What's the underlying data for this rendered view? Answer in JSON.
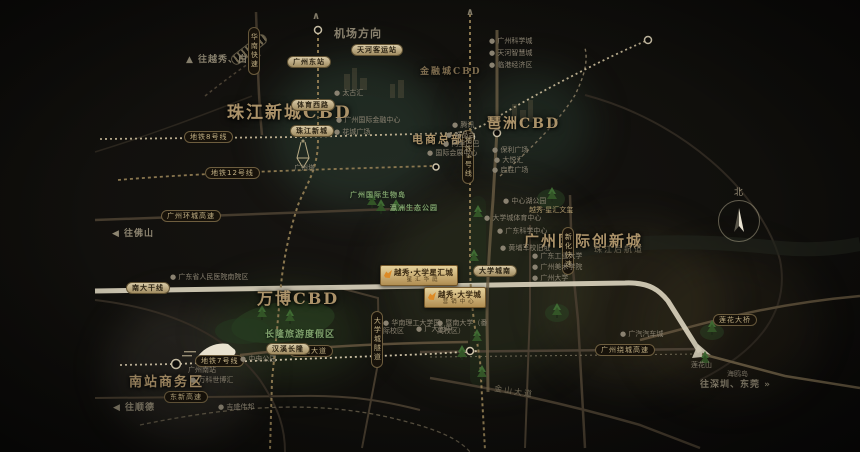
{
  "map": {
    "compass": {
      "label": "北"
    },
    "poi_marker": "●",
    "labels": [
      {
        "k": "r",
        "n": "region-zhujiang-cbd",
        "t": "珠江新城CBD",
        "x": 227,
        "y": 103,
        "fs": 17
      },
      {
        "k": "r",
        "n": "region-pazhou-cbd",
        "t": "琶洲CBD",
        "x": 487,
        "y": 116,
        "fs": 14
      },
      {
        "k": "r",
        "n": "region-financial-city",
        "t": "金融城CBD",
        "x": 420,
        "y": 67,
        "fs": 9,
        "dim": true
      },
      {
        "k": "r",
        "n": "region-ecommerce-hq",
        "t": "电商总部",
        "x": 412,
        "y": 133,
        "fs": 11
      },
      {
        "k": "r",
        "n": "region-innovation-city",
        "t": "广州国际创新城",
        "x": 524,
        "y": 232,
        "fs": 15
      },
      {
        "k": "r",
        "n": "region-wanbo-cbd",
        "t": "万博CBD",
        "x": 257,
        "y": 289,
        "fs": 16
      },
      {
        "k": "r",
        "n": "region-south-station-biz",
        "t": "南站商务区",
        "x": 129,
        "y": 375,
        "fs": 13
      },
      {
        "k": "d",
        "n": "direction-airport",
        "t": "机场方向",
        "x": 334,
        "y": 27,
        "fs": 11
      },
      {
        "k": "d",
        "n": "chevron-up-icon",
        "t": "∧",
        "x": 312,
        "y": 11,
        "fs": 10
      },
      {
        "k": "d",
        "n": "chevron-up-icon",
        "t": "∧",
        "x": 466,
        "y": 7,
        "fs": 10
      },
      {
        "k": "d",
        "n": "direction-yuexiu-baiyun",
        "t": "▲ 往越秀、白云",
        "x": 186,
        "y": 55
      },
      {
        "k": "d",
        "n": "direction-foshan",
        "t": "◀ 往佛山",
        "x": 112,
        "y": 229
      },
      {
        "k": "d",
        "n": "direction-shunde",
        "t": "◀ 往顺德",
        "x": 113,
        "y": 403
      },
      {
        "k": "d",
        "n": "direction-shenzhen-dongguan",
        "t": "往深圳、东莞 »",
        "x": 700,
        "y": 380
      },
      {
        "k": "p",
        "n": "road-pill-metro8",
        "t": "地铁8号线",
        "x": 184,
        "y": 131
      },
      {
        "k": "p",
        "n": "road-pill-metro12",
        "t": "地铁12号线",
        "x": 205,
        "y": 167
      },
      {
        "k": "p",
        "n": "road-pill-huancheng-expwy",
        "t": "广州环城高速",
        "x": 161,
        "y": 210
      },
      {
        "k": "p",
        "n": "road-pill-metro7",
        "t": "地铁7号线",
        "x": 195,
        "y": 355
      },
      {
        "k": "p",
        "n": "road-pill-dongxin-expwy",
        "t": "东新高速",
        "x": 164,
        "y": 391
      },
      {
        "k": "p",
        "n": "road-pill-hanxi-avenue",
        "t": "汉溪大道",
        "x": 289,
        "y": 345
      },
      {
        "k": "p",
        "n": "road-pill-raocheng-expwy",
        "t": "广州绕城高速",
        "x": 595,
        "y": 344
      },
      {
        "k": "p",
        "n": "road-pill-lianhua-bridge",
        "t": "莲花大桥",
        "x": 713,
        "y": 314
      },
      {
        "k": "p",
        "n": "road-pill-huanan-expwy",
        "t": "华南快速",
        "x": 248,
        "y": 27,
        "v": true
      },
      {
        "k": "p",
        "n": "road-pill-metro4",
        "t": "地铁4号线",
        "x": 462,
        "y": 130,
        "v": true
      },
      {
        "k": "p",
        "n": "road-pill-xinhua-expwy",
        "t": "新化快速",
        "x": 562,
        "y": 227,
        "v": true
      },
      {
        "k": "p",
        "n": "road-pill-uc-tunnel",
        "t": "大学城隧道",
        "x": 371,
        "y": 311,
        "v": true
      },
      {
        "k": "s",
        "n": "road-pill-nanda-trunk",
        "t": "南大干线",
        "x": 126,
        "y": 282
      },
      {
        "k": "s",
        "n": "station-tianhe-bus",
        "t": "天河客运站",
        "x": 351,
        "y": 44
      },
      {
        "k": "s",
        "n": "station-guangzhou-east",
        "t": "广州东站",
        "x": 287,
        "y": 56
      },
      {
        "k": "s",
        "n": "station-tiyu-xilu",
        "t": "体育西路",
        "x": 291,
        "y": 99
      },
      {
        "k": "s",
        "n": "station-zhujiang-new-town",
        "t": "珠江新城",
        "x": 290,
        "y": 125
      },
      {
        "k": "s",
        "n": "station-uc-south",
        "t": "大学城南",
        "x": 473,
        "y": 265
      },
      {
        "k": "s",
        "n": "station-hanxi-changlong",
        "t": "汉溪长隆",
        "x": 266,
        "y": 343
      },
      {
        "k": "o",
        "n": "poi-taikoo-hui",
        "t": "太古汇",
        "x": 334,
        "y": 89
      },
      {
        "k": "o",
        "n": "poi-gz-ifc",
        "t": "广州国际金融中心",
        "x": 336,
        "y": 116
      },
      {
        "k": "o",
        "n": "poi-huacheng-square",
        "t": "花城广场",
        "x": 334,
        "y": 128
      },
      {
        "k": "o",
        "n": "poi-canton-tower",
        "t": "广州塔",
        "x": 294,
        "y": 164,
        "dot": false
      },
      {
        "k": "o",
        "n": "poi-tencent",
        "t": "腾讯",
        "x": 452,
        "y": 121
      },
      {
        "k": "o",
        "n": "poi-vipshop",
        "t": "唯品会",
        "x": 446,
        "y": 131
      },
      {
        "k": "o",
        "n": "poi-alibaba",
        "t": "阿里巴巴",
        "x": 443,
        "y": 140
      },
      {
        "k": "o",
        "n": "poi-convention-center",
        "t": "国际会展中心",
        "x": 427,
        "y": 149
      },
      {
        "k": "o",
        "n": "poi-poly-plaza",
        "t": "保利广场",
        "x": 492,
        "y": 146
      },
      {
        "k": "o",
        "n": "poi-dayue-hui",
        "t": "大悦汇",
        "x": 494,
        "y": 156
      },
      {
        "k": "o",
        "n": "poi-qisheng-plaza",
        "t": "启胜广场",
        "x": 492,
        "y": 166
      },
      {
        "k": "o",
        "n": "poi-science-city",
        "t": "广州科学城",
        "x": 489,
        "y": 37
      },
      {
        "k": "o",
        "n": "poi-smart-city",
        "t": "天河智慧城",
        "x": 489,
        "y": 49
      },
      {
        "k": "o",
        "n": "poi-port-economic-zone",
        "t": "临港经济区",
        "x": 489,
        "y": 61
      },
      {
        "k": "o",
        "n": "poi-gd-science-center",
        "t": "广东科学中心",
        "x": 497,
        "y": 227
      },
      {
        "k": "o",
        "n": "poi-huangpu-military-academy",
        "t": "黄埔军校旧址",
        "x": 500,
        "y": 244
      },
      {
        "k": "o",
        "n": "poi-gdut",
        "t": "广东工业大学",
        "x": 532,
        "y": 252
      },
      {
        "k": "o",
        "n": "poi-gafa",
        "t": "广州美术学院",
        "x": 532,
        "y": 263
      },
      {
        "k": "o",
        "n": "poi-guangzhou-university",
        "t": "广州大学",
        "x": 532,
        "y": 274
      },
      {
        "k": "o",
        "n": "poi-central-lake-park",
        "t": "中心湖公园",
        "x": 503,
        "y": 197
      },
      {
        "k": "o",
        "n": "poi-uc-sports-center",
        "t": "大学城体育中心",
        "x": 484,
        "y": 214
      },
      {
        "k": "o",
        "n": "poi-scut-intl-campus",
        "t": "华南理工大学国际校区",
        "x": 383,
        "y": 319,
        "w": 58
      },
      {
        "k": "o",
        "n": "poi-gdfz",
        "t": "广大附中",
        "x": 416,
        "y": 325
      },
      {
        "k": "o",
        "n": "poi-jinan-university",
        "t": "暨南大学（番禺校区）",
        "x": 437,
        "y": 319,
        "w": 55
      },
      {
        "k": "o",
        "n": "poi-provincial-hospital",
        "t": "广东省人民医院南院区",
        "x": 170,
        "y": 273
      },
      {
        "k": "o",
        "n": "poi-guangzhou-south-station",
        "t": "广州南站",
        "x": 188,
        "y": 366,
        "dot": false
      },
      {
        "k": "o",
        "n": "poi-vanke-expo-hub",
        "t": "万科世博汇",
        "x": 190,
        "y": 376
      },
      {
        "k": "o",
        "n": "poi-jisheng-weibang",
        "t": "吉盛伟邦",
        "x": 218,
        "y": 403
      },
      {
        "k": "o",
        "n": "poi-central-park",
        "t": "中央公园",
        "x": 240,
        "y": 355
      },
      {
        "k": "o",
        "n": "poi-gac-auto-city",
        "t": "广汽汽车城",
        "x": 620,
        "y": 330
      },
      {
        "k": "o",
        "n": "poi-lianhua-mountain",
        "t": "莲花山",
        "x": 691,
        "y": 361,
        "dot": false
      },
      {
        "k": "o",
        "n": "poi-haiou-island",
        "t": "海鸥岛",
        "x": 727,
        "y": 370,
        "dot": false
      },
      {
        "k": "og",
        "n": "poi-xinghui-wenxi",
        "t": "越秀·星汇文玺",
        "x": 529,
        "y": 206,
        "dot": false
      },
      {
        "k": "g",
        "n": "park-changlong-resort",
        "t": "长隆旅游度假区",
        "x": 265,
        "y": 330,
        "fs": 9
      },
      {
        "k": "g",
        "n": "park-bio-island",
        "t": "广州国际生物岛",
        "x": 350,
        "y": 191,
        "fs": 7
      },
      {
        "k": "g",
        "n": "park-yingzhou-eco",
        "t": "瀛洲生态公园",
        "x": 390,
        "y": 204,
        "fs": 7
      },
      {
        "k": "w",
        "n": "river-zhujiang-rear-channel",
        "t": "珠江后航道",
        "x": 594,
        "y": 245
      },
      {
        "k": "w",
        "n": "road-jinshan-avenue",
        "t": "金山大道",
        "x": 494,
        "y": 387,
        "rot": 9
      },
      {
        "k": "b",
        "n": "project-badge-main",
        "t": "越秀·大学星汇城",
        "sub": "星汇华庭",
        "x": 380,
        "y": 265
      },
      {
        "k": "b",
        "n": "project-badge-secondary",
        "t": "越秀·大学城",
        "sub": "营销中心",
        "x": 424,
        "y": 287
      }
    ]
  }
}
